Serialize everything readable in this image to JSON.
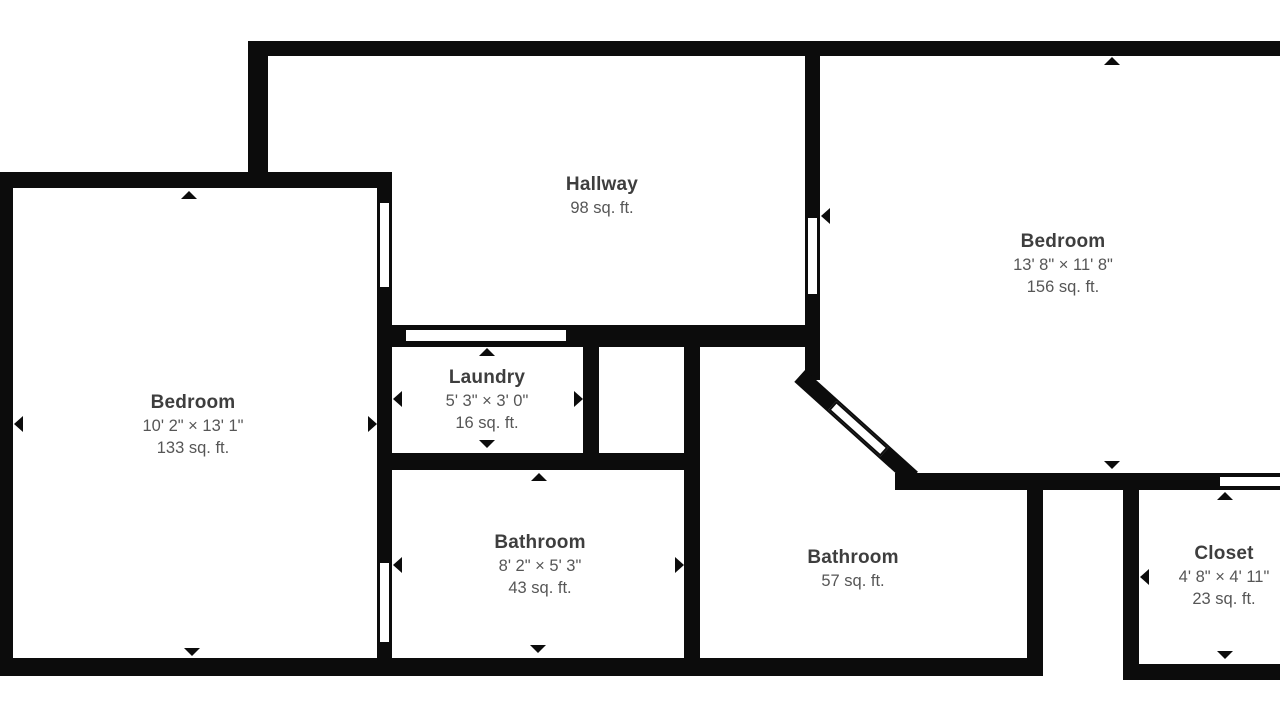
{
  "figure": {
    "type": "floor-plan",
    "colors": {
      "background": "#ffffff",
      "wall": "#0c0c0c",
      "room_title": "#3e3e3e",
      "room_subtitle": "#565656"
    },
    "icons": {
      "dimension_arrow": "small black triangle marker pointing at wall"
    }
  },
  "rooms": [
    {
      "name": "Hallway",
      "dimensions": "",
      "area": "98 sq. ft."
    },
    {
      "name": "Bedroom",
      "dimensions": "13' 8\" × 11' 8\"",
      "area": "156 sq. ft."
    },
    {
      "name": "Bedroom",
      "dimensions": "10' 2\" × 13' 1\"",
      "area": "133 sq. ft."
    },
    {
      "name": "Laundry",
      "dimensions": "5' 3\" × 3' 0\"",
      "area": "16 sq. ft."
    },
    {
      "name": "Bathroom",
      "dimensions": "8' 2\" × 5' 3\"",
      "area": "43 sq. ft."
    },
    {
      "name": "Bathroom",
      "dimensions": "",
      "area": "57 sq. ft."
    },
    {
      "name": "Closet",
      "dimensions": "4' 8\" × 4' 11\"",
      "area": "23 sq. ft."
    }
  ]
}
